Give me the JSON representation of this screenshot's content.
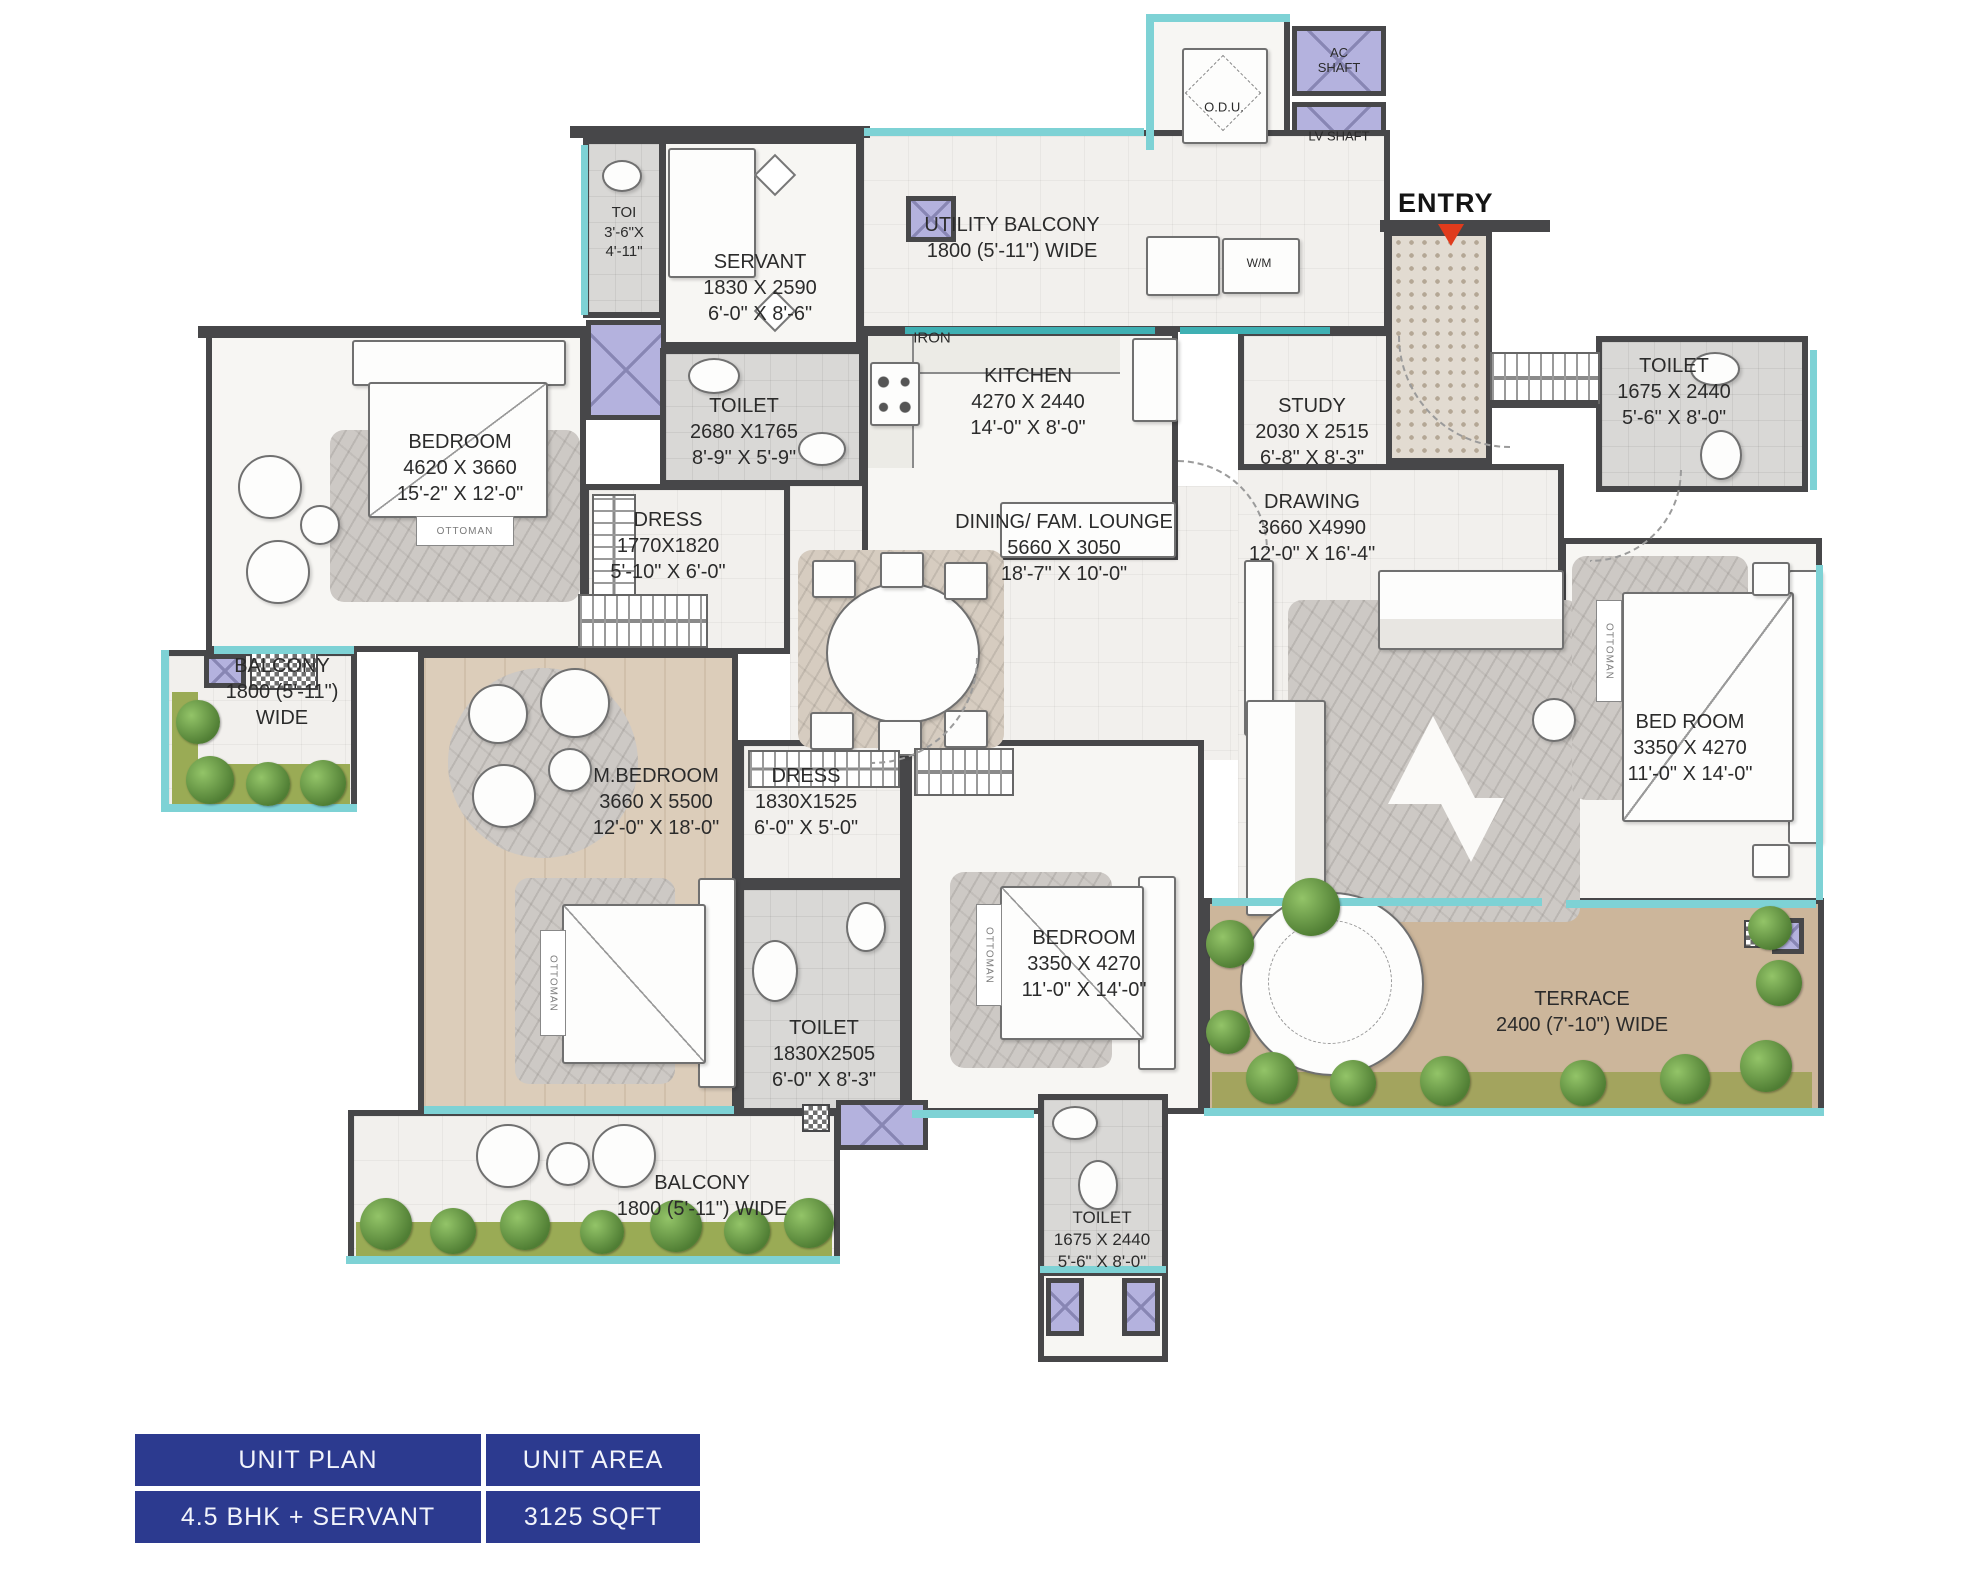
{
  "title": "Unit floor plan",
  "labels": {
    "entry": "ENTRY",
    "odu": "O.D.U.",
    "ac_shaft": "AC SHAFT",
    "lv_shaft": "LV SHAFT",
    "iron": "IRON",
    "wm": "W/M",
    "ottoman": "OTTOMAN"
  },
  "rooms": {
    "toi": {
      "name": "TOI",
      "l1": "3'-6\"X",
      "l2": "4'-11\""
    },
    "servant": {
      "name": "SERVANT",
      "metric": "1830 X 2590",
      "imperial": "6'-0\" X 8'-6\""
    },
    "utility_balcony": {
      "name": "UTILITY BALCONY",
      "size": "1800 (5'-11\") WIDE"
    },
    "toilet_common": {
      "name": "TOILET",
      "metric": "2680 X1765",
      "imperial": "8'-9\" X 5'-9\""
    },
    "kitchen": {
      "name": "KITCHEN",
      "metric": "4270 X 2440",
      "imperial": "14'-0\" X 8'-0\""
    },
    "study": {
      "name": "STUDY",
      "metric": "2030 X 2515",
      "imperial": "6'-8\" X 8'-3\""
    },
    "toilet_entry": {
      "name": "TOILET",
      "metric": "1675 X 2440",
      "imperial": "5'-6\" X 8'-0\""
    },
    "bedroom_left": {
      "name": "BEDROOM",
      "metric": "4620 X 3660",
      "imperial": "15'-2\" X 12'-0\""
    },
    "dress_left": {
      "name": "DRESS",
      "metric": "1770X1820",
      "imperial": "5'-10\" X 6'-0\""
    },
    "dining": {
      "name": "DINING/ FAM. LOUNGE",
      "metric": "5660 X 3050",
      "imperial": "18'-7\" X 10'-0\""
    },
    "drawing": {
      "name": "DRAWING",
      "metric": "3660 X4990",
      "imperial": "12'-0\" X 16'-4\""
    },
    "balcony_left": {
      "name": "BALCONY",
      "l1": "1800 (5'-11\")",
      "l2": "WIDE"
    },
    "m_bedroom": {
      "name": "M.BEDROOM",
      "metric": "3660 X 5500",
      "imperial": "12'-0\" X 18'-0\""
    },
    "dress_master": {
      "name": "DRESS",
      "metric": "1830X1525",
      "imperial": "6'-0\" X 5'-0\""
    },
    "bedroom_right": {
      "name": "BED ROOM",
      "metric": "3350 X 4270",
      "imperial": "11'-0\" X 14'-0\""
    },
    "bedroom_bottom": {
      "name": "BEDROOM",
      "metric": "3350 X 4270",
      "imperial": "11'-0\" X 14'-0\""
    },
    "toilet_master": {
      "name": "TOILET",
      "metric": "1830X2505",
      "imperial": "6'-0\" X 8'-3\""
    },
    "terrace": {
      "name": "TERRACE",
      "size": "2400 (7'-10\") WIDE"
    },
    "balcony_bottom": {
      "name": "BALCONY",
      "size": "1800 (5'-11\") WIDE"
    },
    "toilet_bottom": {
      "name": "TOILET",
      "metric": "1675 X 2440",
      "imperial": "5'-6\" X 8'-0\""
    }
  },
  "summary": {
    "col1_header": "UNIT PLAN",
    "col2_header": "UNIT AREA",
    "col1_value": "4.5 BHK + SERVANT",
    "col2_value": "3125 SQFT"
  },
  "colors": {
    "wall": "#474749",
    "window_glass": "#7ed2d5",
    "shaft_fill": "#b4b2de",
    "terrace_floor": "#ccb69b",
    "plant_green": "#507e34",
    "table_navy": "#2c3a8f",
    "entry_arrow_red": "#e03b1c"
  }
}
